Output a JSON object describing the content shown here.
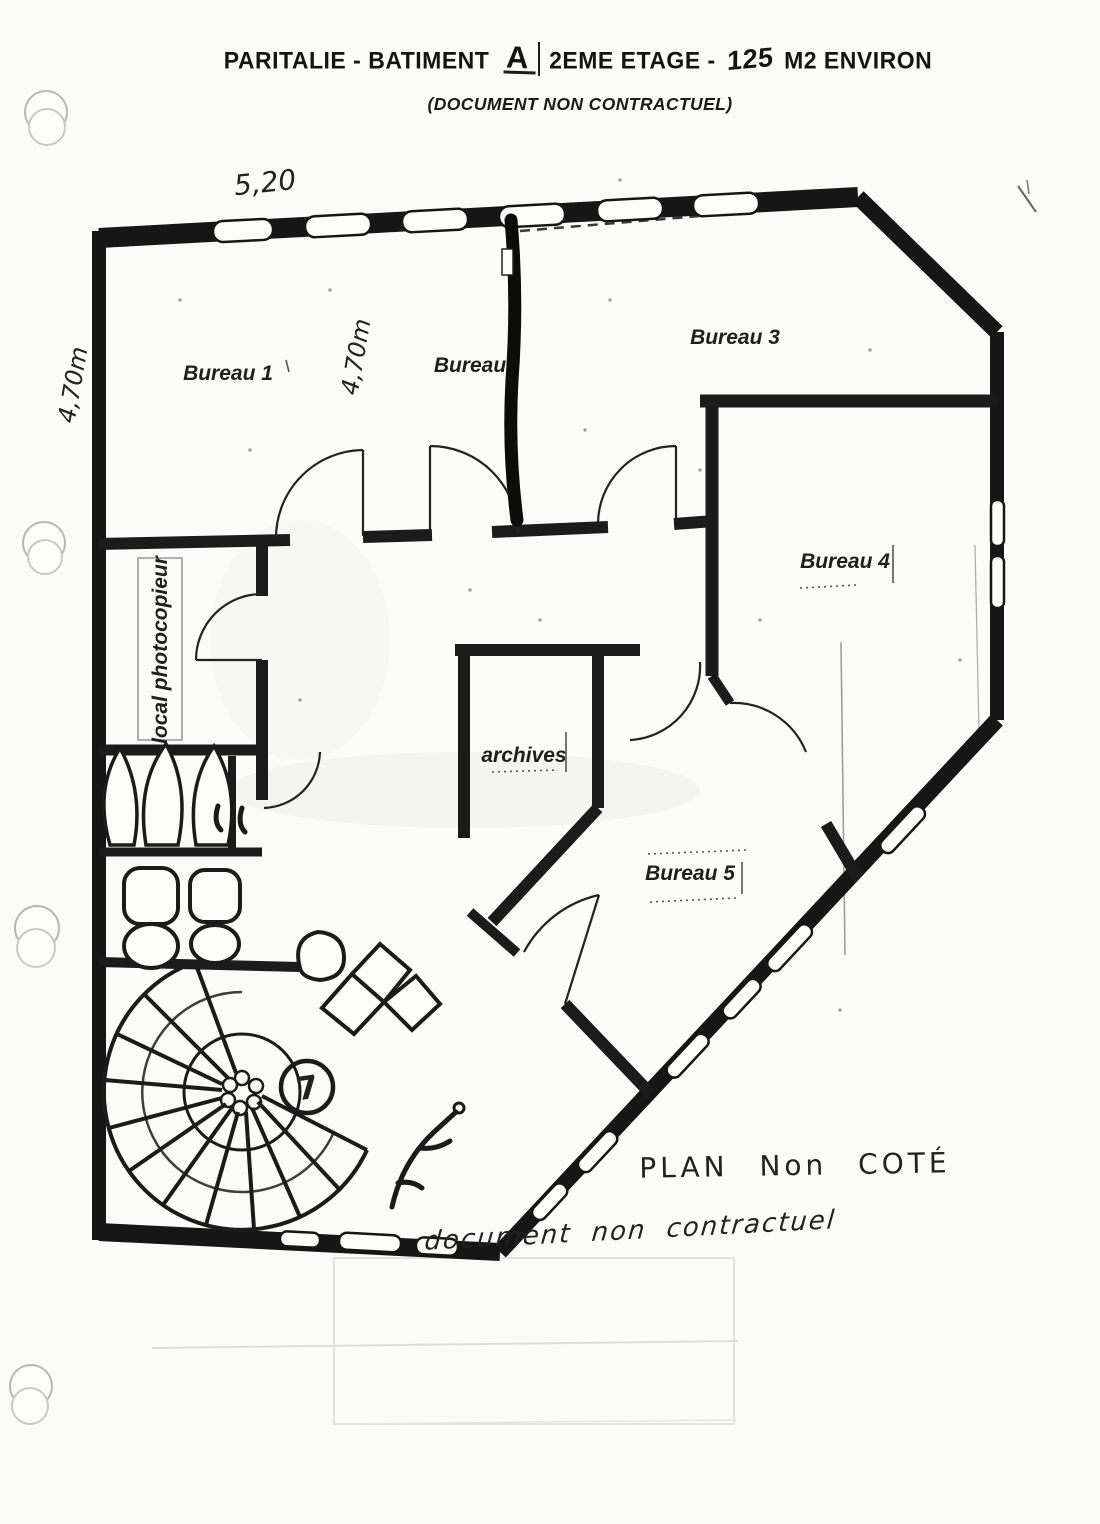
{
  "header": {
    "title_prefix": "PARITALIE - BATIMENT",
    "title_building": "A",
    "title_mid": "2EME ETAGE -",
    "title_area_value": "125",
    "title_suffix": "M2 ENVIRON",
    "subtitle": "(DOCUMENT NON CONTRACTUEL)"
  },
  "rooms": {
    "bureau1": "Bureau 1",
    "bureau2": "Bureau",
    "bureau3": "Bureau 3",
    "bureau4": "Bureau 4",
    "bureau5": "Bureau 5",
    "archives": "archives",
    "photocopier": "local photocopieur"
  },
  "annotations": {
    "top_dimension": "5,20",
    "left_dimension": "4,70m",
    "middle_dimension": "4,70m",
    "stair_circle_number": "7",
    "note_line1": "PLAN Non COTÉ",
    "note_line2": "document non contractuel"
  },
  "colors": {
    "ink": "#1a1a1a",
    "paper": "#fbfbf9",
    "faint_gray": "#b8b8b2"
  }
}
